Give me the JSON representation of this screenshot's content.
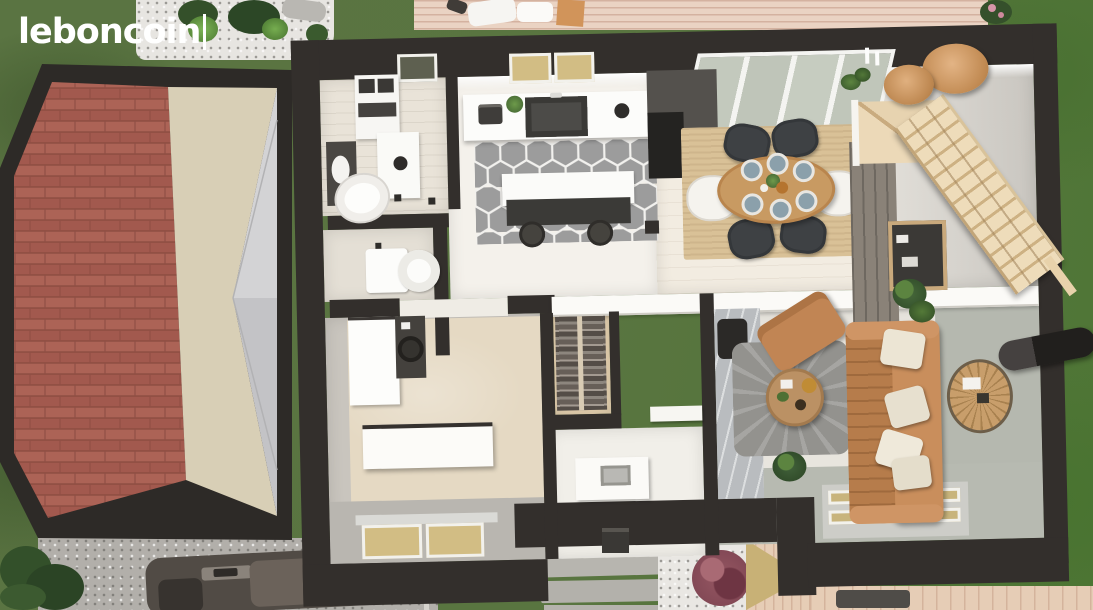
{
  "brand": {
    "logo_text": "leboncoin",
    "logo_color": "#ffffff",
    "cursor_visible": true
  },
  "scene": {
    "description": "top-down 3D architectural render of a house ground floor with garden, roof cut-away, driveway and car",
    "rooms": [
      "laundry-bathroom",
      "wc",
      "hallway",
      "kitchen",
      "dining-area",
      "stair-hall",
      "bedroom-office",
      "dressing",
      "bathroom",
      "living-room"
    ],
    "outdoor": [
      "lawn",
      "white-gravel-bed",
      "terrace-deck-top",
      "terrace-deck-bottom",
      "gravel-driveway",
      "stepping-stone-pavers",
      "purple-shrub",
      "hedge",
      "car",
      "roof-cutaway",
      "stove-pipe"
    ]
  },
  "furniture": [
    "washer-dryer-stack",
    "skylight",
    "toilet",
    "toilet-wc",
    "laundry-vanity",
    "kitchen-counter",
    "kitchen-sink",
    "kitchen-island",
    "bar-stools",
    "tall-fridge-unit",
    "sliding-glass-doors",
    "dining-table",
    "dining-plates",
    "dining-chairs",
    "jute-rug",
    "pendant-lamps",
    "candles",
    "staircase",
    "winder-steps",
    "shelf-unit",
    "indoor-plants",
    "desk",
    "office-chair",
    "wardrobe",
    "sideboard",
    "hanging-clothes",
    "bathroom-vanity",
    "shower-marble-wall",
    "tv-panel",
    "armchair",
    "sofa",
    "coffee-table",
    "round-gray-rug",
    "wire-side-table",
    "floor-windows"
  ],
  "palette": {
    "wall": "#332f2c",
    "floor-white": "#f4f1eb",
    "wood-floor": "#f2ece1",
    "hex-tile": "#9c9c9c",
    "roof-brick": "#a4564a",
    "roof-beige": "#d8cfb6",
    "roof-gray": "#cbcbcd",
    "deck": "#ead3c3",
    "gravel": "#b2afaa",
    "white-gravel": "#e9e7e3",
    "carpet": "#e5d9c3",
    "jute": "#d9c197",
    "table-wood": "#c89a62",
    "plate": "#8ba0ab",
    "chair-dark": "#3e4144",
    "sofa": "#c18554",
    "rug-gray": "#9c9b97",
    "stairs": "#ecd9b8",
    "marble": "#b9bcbf",
    "window": "#d2bd84",
    "door-sage": "#c3c9bd",
    "bush-purple": "#955762",
    "car-body": "#514b45",
    "grass": "#597540"
  }
}
